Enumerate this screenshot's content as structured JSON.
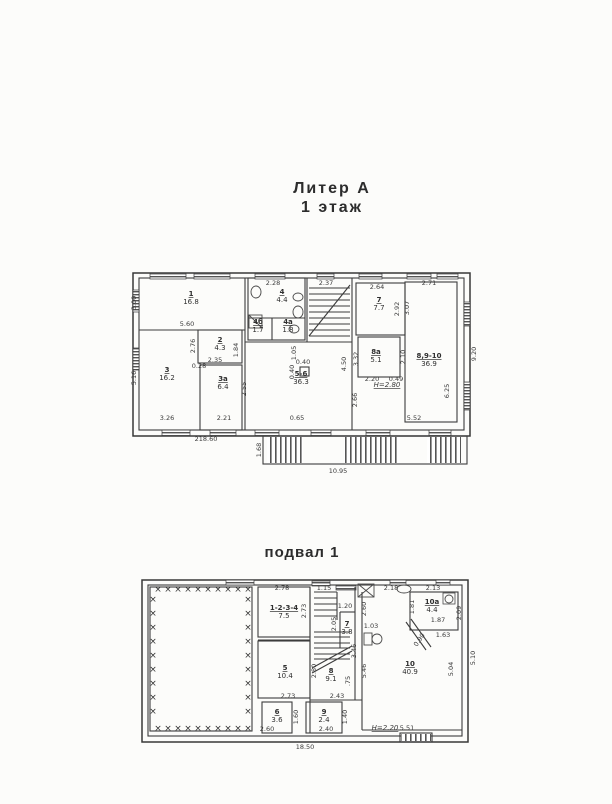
{
  "titles": {
    "block": "Литер А",
    "floor": "1 этаж",
    "basement": "подвал 1"
  },
  "colors": {
    "ink": "#3c3c3c",
    "paper": "#fcfcfa"
  },
  "floor1": {
    "rects": [
      [
        133,
        273,
        337,
        163,
        "thick"
      ],
      [
        139,
        278,
        325,
        152,
        "wall"
      ],
      [
        198,
        330,
        44,
        33,
        "wall"
      ],
      [
        200,
        365,
        42,
        65,
        "wall"
      ],
      [
        248,
        278,
        57,
        62,
        "wall"
      ],
      [
        356,
        283,
        49,
        52,
        "wall"
      ],
      [
        358,
        337,
        42,
        40,
        "wall"
      ],
      [
        405,
        282,
        52,
        140,
        "wall"
      ],
      [
        300,
        367,
        9,
        9,
        "wall"
      ],
      [
        263,
        436,
        204,
        28,
        "wall"
      ]
    ],
    "lines": [
      [
        245,
        278,
        245,
        430
      ],
      [
        307,
        278,
        307,
        342
      ],
      [
        352,
        278,
        352,
        430
      ],
      [
        139,
        330,
        245,
        330
      ],
      [
        245,
        342,
        352,
        342
      ],
      [
        248,
        318,
        305,
        318
      ],
      [
        272,
        318,
        272,
        340
      ],
      [
        309,
        288,
        350,
        288
      ],
      [
        309,
        294,
        350,
        294
      ],
      [
        309,
        300,
        350,
        300
      ],
      [
        309,
        306,
        350,
        306
      ],
      [
        309,
        312,
        350,
        312
      ],
      [
        309,
        318,
        350,
        318
      ],
      [
        309,
        324,
        350,
        324
      ],
      [
        309,
        330,
        350,
        330
      ],
      [
        309,
        336,
        350,
        336
      ],
      [
        309,
        336,
        350,
        285
      ]
    ],
    "windows": [
      [
        150,
        273,
        36,
        6
      ],
      [
        194,
        273,
        36,
        6
      ],
      [
        255,
        273,
        30,
        6
      ],
      [
        317,
        273,
        17,
        6
      ],
      [
        359,
        273,
        23,
        6
      ],
      [
        407,
        273,
        24,
        6
      ],
      [
        437,
        273,
        21,
        6
      ],
      [
        162,
        430,
        28,
        6
      ],
      [
        210,
        430,
        26,
        6
      ],
      [
        255,
        430,
        24,
        6
      ],
      [
        311,
        430,
        20,
        6
      ],
      [
        366,
        430,
        24,
        6
      ],
      [
        429,
        430,
        22,
        6
      ],
      [
        133,
        290,
        6,
        22
      ],
      [
        133,
        348,
        6,
        22
      ],
      [
        464,
        302,
        6,
        24
      ],
      [
        464,
        382,
        6,
        28
      ]
    ],
    "stripes": [
      [
        267,
        437,
        36,
        26
      ],
      [
        344,
        437,
        56,
        26
      ],
      [
        427,
        437,
        34,
        26
      ]
    ],
    "shapes": [
      {
        "k": "ellipse",
        "cx": 256,
        "cy": 292,
        "rx": 5,
        "ry": 6
      },
      {
        "k": "ellipse",
        "cx": 298,
        "cy": 297,
        "rx": 5,
        "ry": 4
      },
      {
        "k": "ellipse",
        "cx": 298,
        "cy": 312,
        "rx": 5,
        "ry": 6
      },
      {
        "k": "rect",
        "x": 249,
        "y": 315,
        "w": 13,
        "h": 13
      },
      {
        "k": "line",
        "x1": 249,
        "y1": 315,
        "x2": 262,
        "y2": 328
      },
      {
        "k": "ellipse",
        "cx": 294,
        "cy": 329,
        "rx": 5,
        "ry": 4
      }
    ],
    "rooms": [
      {
        "num": "1",
        "area": "16.8",
        "x": 191,
        "y": 296
      },
      {
        "num": "2",
        "area": "4.3",
        "x": 220,
        "y": 342
      },
      {
        "num": "3",
        "area": "16.2",
        "x": 167,
        "y": 372
      },
      {
        "num": "3а",
        "area": "6.4",
        "x": 223,
        "y": 381
      },
      {
        "num": "4",
        "area": "4.4",
        "x": 282,
        "y": 294
      },
      {
        "num": "4б",
        "area": "1.7",
        "x": 258,
        "y": 324
      },
      {
        "num": "4а",
        "area": "1.8",
        "x": 288,
        "y": 324
      },
      {
        "num": "5-6",
        "area": "36.3",
        "x": 301,
        "y": 376
      },
      {
        "num": "7",
        "area": "7.7",
        "x": 379,
        "y": 302
      },
      {
        "num": "8а",
        "area": "5.1",
        "x": 376,
        "y": 354
      },
      {
        "num": "8,9-10",
        "area": "36.9",
        "x": 429,
        "y": 358
      }
    ],
    "dims": [
      {
        "t": "5.60",
        "x": 187,
        "y": 326
      },
      {
        "t": "2.28",
        "x": 273,
        "y": 285
      },
      {
        "t": "2.37",
        "x": 326,
        "y": 285
      },
      {
        "t": "2.64",
        "x": 377,
        "y": 289
      },
      {
        "t": "2.71",
        "x": 429,
        "y": 285
      },
      {
        "t": "3.00",
        "x": 136,
        "y": 303,
        "r": -90
      },
      {
        "t": "5.16",
        "x": 136,
        "y": 378,
        "r": -90
      },
      {
        "t": "9.20",
        "x": 476,
        "y": 354,
        "r": -90
      },
      {
        "t": "2.76",
        "x": 195,
        "y": 346,
        "r": -90
      },
      {
        "t": "1.84",
        "x": 238,
        "y": 350,
        "r": -90
      },
      {
        "t": "2.35",
        "x": 215,
        "y": 362
      },
      {
        "t": "0.28",
        "x": 199,
        "y": 368
      },
      {
        "t": "3.26",
        "x": 167,
        "y": 420
      },
      {
        "t": "2.21",
        "x": 224,
        "y": 420
      },
      {
        "t": "2.55",
        "x": 246,
        "y": 389,
        "r": -90
      },
      {
        "t": "1.05",
        "x": 296,
        "y": 353,
        "r": -90
      },
      {
        "t": "0.40",
        "x": 303,
        "y": 364
      },
      {
        "t": "0.40",
        "x": 294,
        "y": 372,
        "r": -90
      },
      {
        "t": "0.65",
        "x": 297,
        "y": 420
      },
      {
        "t": "4.50",
        "x": 346,
        "y": 364,
        "r": -90
      },
      {
        "t": "3.32",
        "x": 358,
        "y": 359,
        "r": -90
      },
      {
        "t": "2.66",
        "x": 357,
        "y": 400,
        "r": -90
      },
      {
        "t": "2.92",
        "x": 399,
        "y": 309,
        "r": -90
      },
      {
        "t": "3.07",
        "x": 409,
        "y": 308,
        "r": -90
      },
      {
        "t": "2.20",
        "x": 372,
        "y": 381
      },
      {
        "t": "0.49",
        "x": 396,
        "y": 381
      },
      {
        "t": "2.10",
        "x": 405,
        "y": 357,
        "r": -90
      },
      {
        "t": "5.52",
        "x": 414,
        "y": 420
      },
      {
        "t": "6.25",
        "x": 449,
        "y": 391,
        "r": -90
      },
      {
        "t": "Н=2.80",
        "x": 387,
        "y": 387,
        "u": true
      },
      {
        "t": "218.60",
        "x": 206,
        "y": 441
      },
      {
        "t": "10.95",
        "x": 338,
        "y": 473
      },
      {
        "t": "1.68",
        "x": 261,
        "y": 450,
        "r": -90
      }
    ]
  },
  "basement": {
    "rects": [
      [
        142,
        580,
        326,
        162,
        "thick"
      ],
      [
        148,
        585,
        314,
        151,
        "wall"
      ],
      [
        150,
        587,
        102,
        144,
        "wall"
      ],
      [
        258,
        587,
        52,
        50,
        "wall"
      ],
      [
        258,
        641,
        52,
        57,
        "wall"
      ],
      [
        262,
        702,
        30,
        31,
        "wall"
      ],
      [
        306,
        702,
        36,
        31,
        "wall"
      ],
      [
        410,
        592,
        48,
        38,
        "wall"
      ],
      [
        400,
        733,
        32,
        9,
        "wall"
      ],
      [
        443,
        593,
        12,
        11,
        "thin"
      ]
    ],
    "lines": [
      [
        310,
        587,
        310,
        733
      ],
      [
        355,
        587,
        355,
        700
      ],
      [
        310,
        700,
        362,
        700
      ],
      [
        362,
        592,
        362,
        730
      ],
      [
        362,
        730,
        462,
        730
      ],
      [
        258,
        637,
        310,
        637
      ],
      [
        258,
        640,
        310,
        640
      ],
      [
        314,
        592,
        337,
        592
      ],
      [
        314,
        598,
        337,
        598
      ],
      [
        314,
        604,
        337,
        604
      ],
      [
        314,
        610,
        337,
        610
      ],
      [
        314,
        616,
        337,
        616
      ],
      [
        337,
        592,
        337,
        620
      ],
      [
        340,
        612,
        355,
        612
      ],
      [
        340,
        612,
        340,
        648
      ],
      [
        314,
        632,
        350,
        632
      ],
      [
        314,
        637,
        350,
        637
      ],
      [
        314,
        643,
        350,
        643
      ],
      [
        314,
        648,
        350,
        648
      ],
      [
        314,
        654,
        350,
        654
      ],
      [
        314,
        659,
        350,
        659
      ],
      [
        312,
        668,
        352,
        646
      ],
      [
        312,
        673,
        352,
        651
      ],
      [
        406,
        622,
        426,
        650
      ],
      [
        411,
        619,
        431,
        647
      ]
    ],
    "windows": [
      [
        226,
        580,
        28,
        5
      ],
      [
        312,
        581,
        18,
        5
      ],
      [
        336,
        585,
        20,
        5
      ],
      [
        390,
        580,
        16,
        5
      ],
      [
        436,
        580,
        14,
        5
      ]
    ],
    "stripes": [
      [
        401,
        734,
        30,
        7
      ]
    ],
    "shapes": [
      {
        "k": "rect",
        "x": 358,
        "y": 584,
        "w": 16,
        "h": 13
      },
      {
        "k": "line",
        "x1": 358,
        "y1": 584,
        "x2": 374,
        "y2": 597
      },
      {
        "k": "line",
        "x1": 374,
        "y1": 584,
        "x2": 358,
        "y2": 597
      },
      {
        "k": "ellipse",
        "cx": 404,
        "cy": 589,
        "rx": 7,
        "ry": 4
      },
      {
        "k": "circle",
        "cx": 449,
        "cy": 599,
        "r": 4
      },
      {
        "k": "rect",
        "x": 364,
        "y": 633,
        "w": 8,
        "h": 12
      },
      {
        "k": "ellipse",
        "cx": 377,
        "cy": 639,
        "rx": 5,
        "ry": 5
      }
    ],
    "xmarks": [
      {
        "x": 158,
        "y": 592,
        "dx": 10,
        "dy": 0,
        "n": 10
      },
      {
        "x": 158,
        "y": 731,
        "dx": 10,
        "dy": 0,
        "n": 10
      },
      {
        "x": 153,
        "y": 602,
        "dx": 0,
        "dy": 14,
        "n": 9
      },
      {
        "x": 248,
        "y": 602,
        "dx": 0,
        "dy": 14,
        "n": 9
      }
    ],
    "rooms": [
      {
        "num": "1-2-3-4",
        "area": "7.5",
        "x": 284,
        "y": 610
      },
      {
        "num": "5",
        "area": "10.4",
        "x": 285,
        "y": 670
      },
      {
        "num": "6",
        "area": "3.6",
        "x": 277,
        "y": 714
      },
      {
        "num": "9",
        "area": "2.4",
        "x": 324,
        "y": 714
      },
      {
        "num": "7",
        "area": "3.8",
        "x": 347,
        "y": 626
      },
      {
        "num": "8",
        "area": "9.1",
        "x": 331,
        "y": 673
      },
      {
        "num": "10",
        "area": "40.9",
        "x": 410,
        "y": 666
      },
      {
        "num": "10а",
        "area": "4.4",
        "x": 432,
        "y": 604
      }
    ],
    "dims": [
      {
        "t": "2.78",
        "x": 282,
        "y": 590
      },
      {
        "t": "1.15",
        "x": 324,
        "y": 590
      },
      {
        "t": "2.18",
        "x": 391,
        "y": 590
      },
      {
        "t": "2.13",
        "x": 433,
        "y": 590
      },
      {
        "t": "2.73",
        "x": 306,
        "y": 611,
        "r": -90
      },
      {
        "t": "1.20",
        "x": 345,
        "y": 608
      },
      {
        "t": "2.05",
        "x": 336,
        "y": 624,
        "r": -90
      },
      {
        "t": "1.03",
        "x": 371,
        "y": 628
      },
      {
        "t": "2.60",
        "x": 366,
        "y": 609,
        "r": -90
      },
      {
        "t": "1.81",
        "x": 414,
        "y": 607,
        "r": -90
      },
      {
        "t": "2.09",
        "x": 461,
        "y": 613,
        "r": -90
      },
      {
        "t": "1.87",
        "x": 438,
        "y": 622
      },
      {
        "t": "1.63",
        "x": 443,
        "y": 637
      },
      {
        "t": "0.90",
        "x": 421,
        "y": 641,
        "r": -55
      },
      {
        "t": "3.46",
        "x": 356,
        "y": 651,
        "r": -90
      },
      {
        "t": "2.80",
        "x": 316,
        "y": 671,
        "r": -90
      },
      {
        "t": ".75",
        "x": 350,
        "y": 681,
        "r": -90
      },
      {
        "t": "5.46",
        "x": 366,
        "y": 671,
        "r": -90
      },
      {
        "t": "2.43",
        "x": 337,
        "y": 698
      },
      {
        "t": "2.73",
        "x": 288,
        "y": 698
      },
      {
        "t": "1.60",
        "x": 298,
        "y": 717,
        "r": -90
      },
      {
        "t": "2.60",
        "x": 267,
        "y": 731
      },
      {
        "t": "2.40",
        "x": 326,
        "y": 731
      },
      {
        "t": "1.40",
        "x": 347,
        "y": 717,
        "r": -90
      },
      {
        "t": "5.04",
        "x": 453,
        "y": 669,
        "r": -90
      },
      {
        "t": "5.51",
        "x": 407,
        "y": 730
      },
      {
        "t": "Н=2.20",
        "x": 385,
        "y": 730,
        "u": true
      },
      {
        "t": "5.10",
        "x": 475,
        "y": 658,
        "r": -90
      },
      {
        "t": "18.50",
        "x": 305,
        "y": 749
      }
    ]
  }
}
